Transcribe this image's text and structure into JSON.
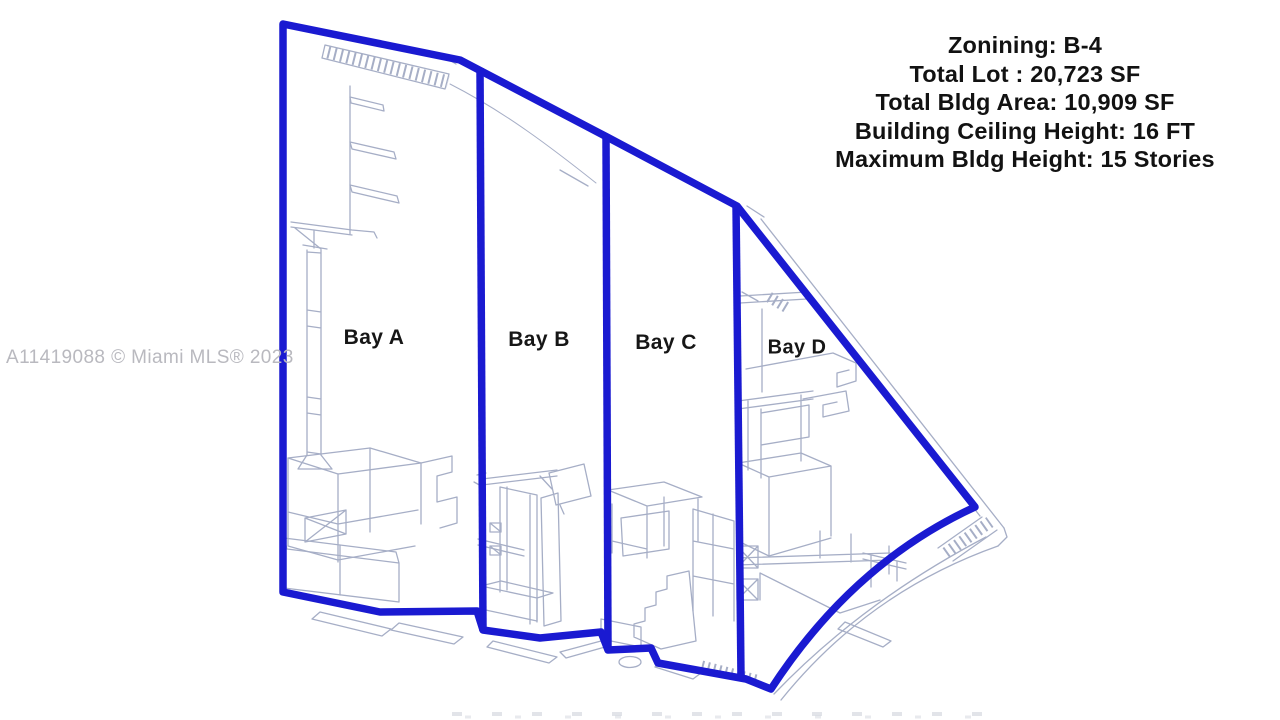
{
  "page": {
    "background": "#ffffff"
  },
  "info_panel": {
    "lines": [
      "Zonining: B-4",
      "Total Lot : 20,723 SF",
      "Total Bldg Area: 10,909 SF",
      "Building Ceiling Height: 16 FT",
      "Maximum Bldg Height: 15 Stories"
    ],
    "text_color": "#121212"
  },
  "floor_plan": {
    "kind": "warehouse-bay-floor-plan-sketch",
    "outline_color": "#1a1ad1",
    "sketch_color": "#a6aec6",
    "bays": [
      {
        "label": "Bay A"
      },
      {
        "label": "Bay B"
      },
      {
        "label": "Bay C"
      },
      {
        "label": "Bay D"
      }
    ]
  },
  "watermark": {
    "text": "A11419088 © Miami MLS® 2023",
    "color": "#b9b9bf"
  }
}
